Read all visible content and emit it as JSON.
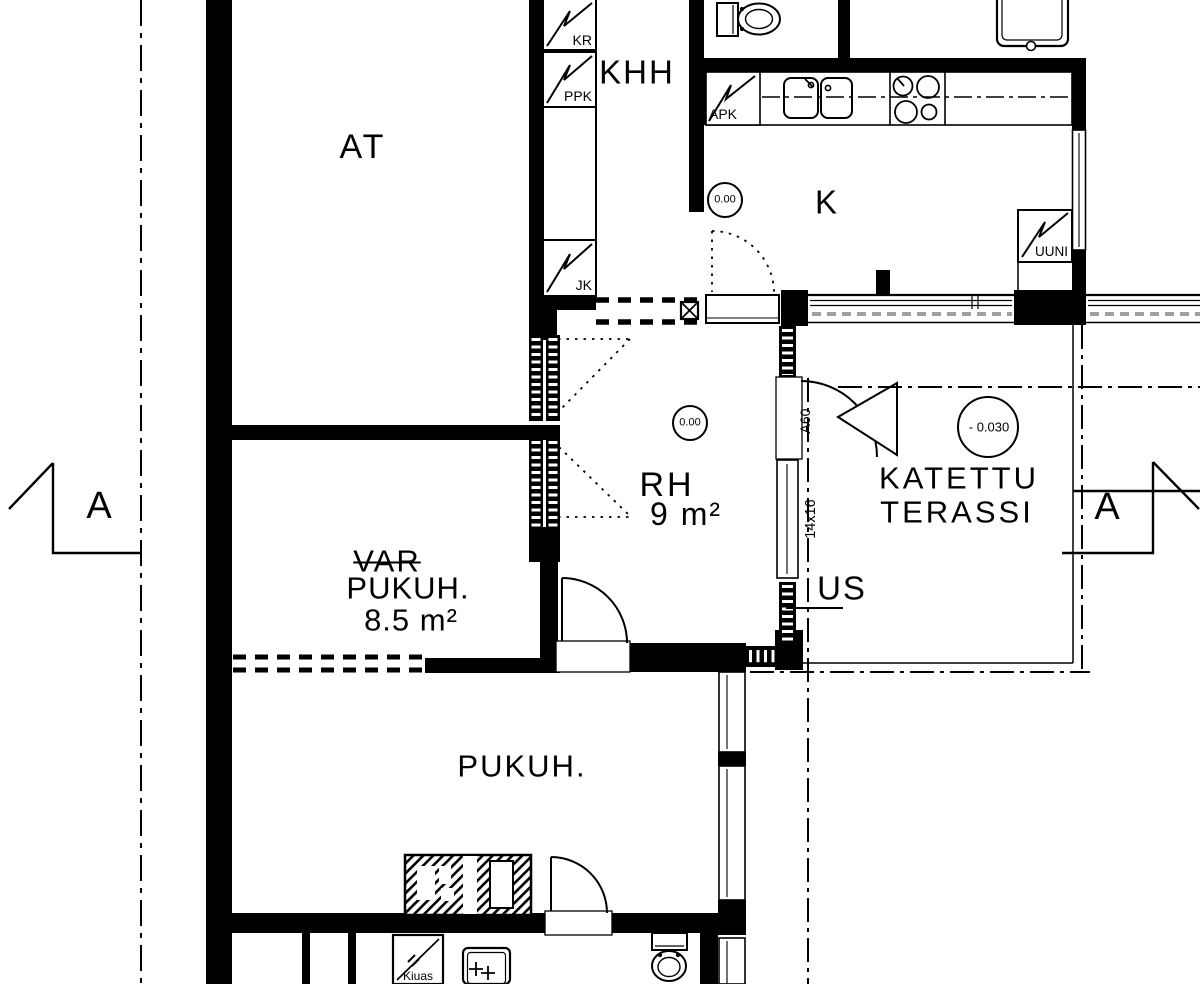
{
  "plan": {
    "rooms": {
      "at": "AT",
      "khh": "KHH",
      "kitchen": "K",
      "rh": "RH",
      "rh_area": "9 m²",
      "var_struck": "VAR",
      "var_room": "PUKUH.",
      "var_area": "8.5 m²",
      "pukuh": "PUKUH.",
      "terrace_line1": "KATETTU",
      "terrace_line2": "TERASSI"
    },
    "appliances": {
      "kr": "KR",
      "ppk": "PPK",
      "jk": "JK",
      "apk": "APK",
      "uuni": "UUNI",
      "kiuas": "Kiuas"
    },
    "elevations": {
      "kitchen": "0.00",
      "rh": "0.00",
      "terrace": "- 0.030"
    },
    "openings": {
      "exterior_wall": "US",
      "door": "A60",
      "window": "14x16"
    },
    "sections": {
      "left": "A",
      "right": "A"
    }
  },
  "colors": {
    "line": "#000000",
    "background": "#ffffff",
    "window_dash": "#a0a0a0"
  }
}
